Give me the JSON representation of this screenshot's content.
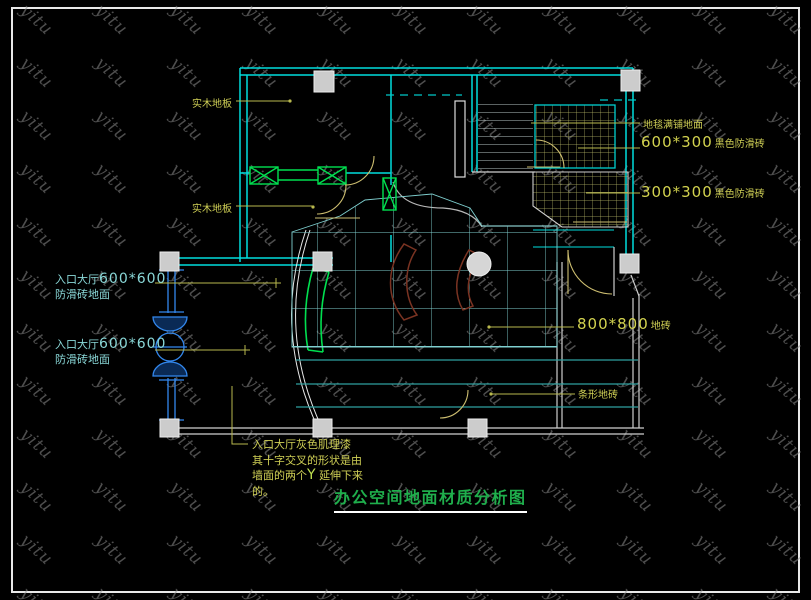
{
  "watermark": {
    "text": "yitu"
  },
  "title": {
    "text": "办公空间地面材质分析图"
  },
  "labels": {
    "wood_floor_1": "实木地板",
    "wood_floor_2": "实木地板",
    "carpet": "地毯满铺地面",
    "tile_600x300": {
      "size": "600*300",
      "desc": "黑色防滑砖"
    },
    "tile_300x300": {
      "size": "300*300",
      "desc": "黑色防滑砖"
    },
    "tile_800x800": {
      "size": "800*800",
      "desc": "地砖"
    },
    "strip_tile": "条形地砖",
    "entry_hall": {
      "prefix": "入口大厅",
      "size": "600*600",
      "line2": "防滑砖地面"
    },
    "note": {
      "line1": "入口大厅灰色肌理漆",
      "line2": "其十字交叉的形状是由",
      "line3_pre": "墙面的两个",
      "line3_y": "Y",
      "line3_post": "延伸下来",
      "line4": "的。"
    }
  },
  "colors": {
    "background": "#000000",
    "wall_cyan": "#00e0e0",
    "wall_blue": "#3388ee",
    "window_green": "#00e050",
    "label_yellow": "#cfcf55",
    "label_cyan": "#8ad8d8",
    "title_green": "#1fae4c",
    "column_gray": "#cccccc",
    "desk_brown": "#7a3322",
    "watermark_gray": "#8f8f8f"
  }
}
